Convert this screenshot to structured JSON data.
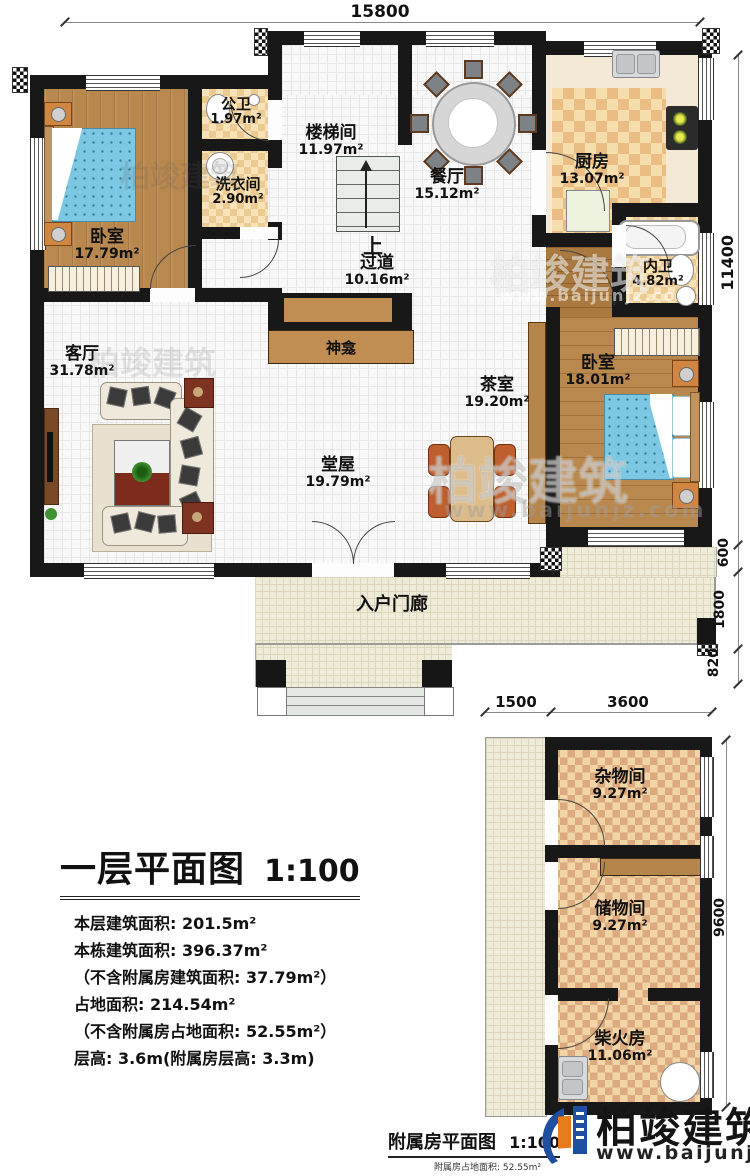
{
  "dimensions": {
    "top": "15800",
    "right_main": "11400",
    "right_600": "600",
    "right_1800": "1800",
    "right_820": "820",
    "annex_1500": "1500",
    "annex_3600": "3600",
    "annex_9600": "9600"
  },
  "rooms": {
    "bedroom_tl": {
      "name": "卧室",
      "area": "17.79m²"
    },
    "public_bath": {
      "name": "公卫",
      "area": "1.97m²"
    },
    "laundry": {
      "name": "洗衣间",
      "area": "2.90m²"
    },
    "stairwell": {
      "name": "楼梯间",
      "area": "11.97m²"
    },
    "dining": {
      "name": "餐厅",
      "area": "15.12m²"
    },
    "kitchen": {
      "name": "厨房",
      "area": "13.07m²"
    },
    "ensuite_bath": {
      "name": "内卫",
      "area": "4.82m²"
    },
    "hallway": {
      "name": "过道",
      "area": "10.16m²"
    },
    "living": {
      "name": "客厅",
      "area": "31.78m²"
    },
    "tea_room": {
      "name": "茶室",
      "area": "19.20m²"
    },
    "bedroom_r": {
      "name": "卧室",
      "area": "18.01m²"
    },
    "main_hall": {
      "name": "堂屋",
      "area": "19.79m²"
    },
    "sundry": {
      "name": "杂物间",
      "area": "9.27m²"
    },
    "storage": {
      "name": "储物间",
      "area": "9.27m²"
    },
    "firewood": {
      "name": "柴火房",
      "area": "11.06m²"
    }
  },
  "labels": {
    "up": "上",
    "shrine": "神龛",
    "porch": "入户门廊"
  },
  "title_block": {
    "title": "一层平面图",
    "scale": "1:100",
    "lines": [
      "本层建筑面积: 201.5m²",
      "本栋建筑面积: 396.37m²",
      "（不含附属房建筑面积: 37.79m²）",
      "占地面积: 214.54m²",
      "（不含附属房占地面积: 52.55m²）",
      "层高: 3.6m(附属房层高: 3.3m)"
    ]
  },
  "annex_caption": {
    "title": "附属房平面图",
    "scale": "1:100",
    "note": "附属房占地面积: 52.55m²"
  },
  "brand": {
    "name": "柏竣建筑",
    "url": "www.baijunjz.com"
  }
}
